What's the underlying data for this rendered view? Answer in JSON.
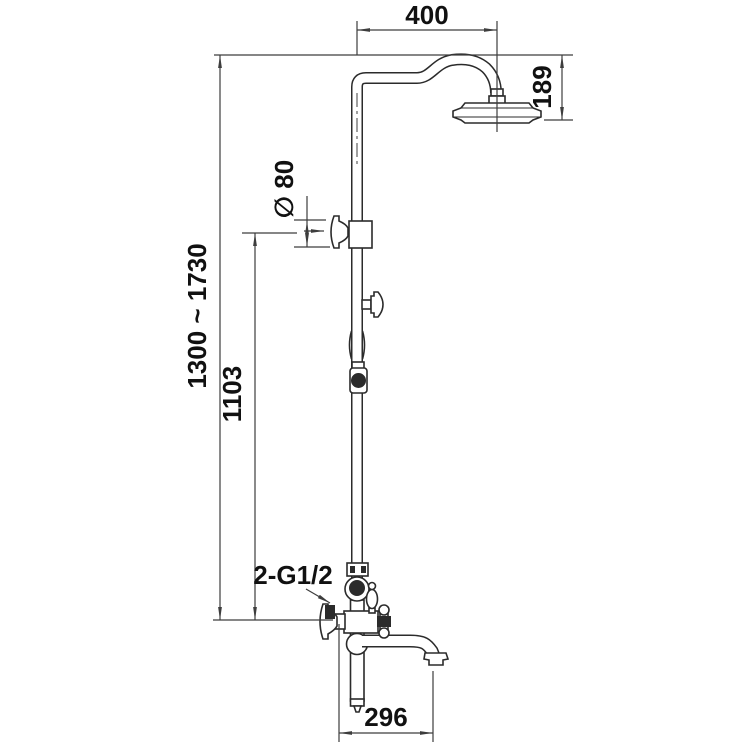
{
  "drawing": {
    "background_color": "#ffffff",
    "dimension_line_color": "#3d3d3d",
    "fixture_line_color": "#2b2b2b",
    "text_color": "#111111",
    "labels": {
      "arm_reach": "400",
      "head_height": "189",
      "flange_diameter": "∅ 80",
      "overall_height_range": "1300 ~ 1730",
      "riser_height": "1103",
      "inlet_thread": "2-G1/2",
      "spout_reach": "296"
    }
  }
}
